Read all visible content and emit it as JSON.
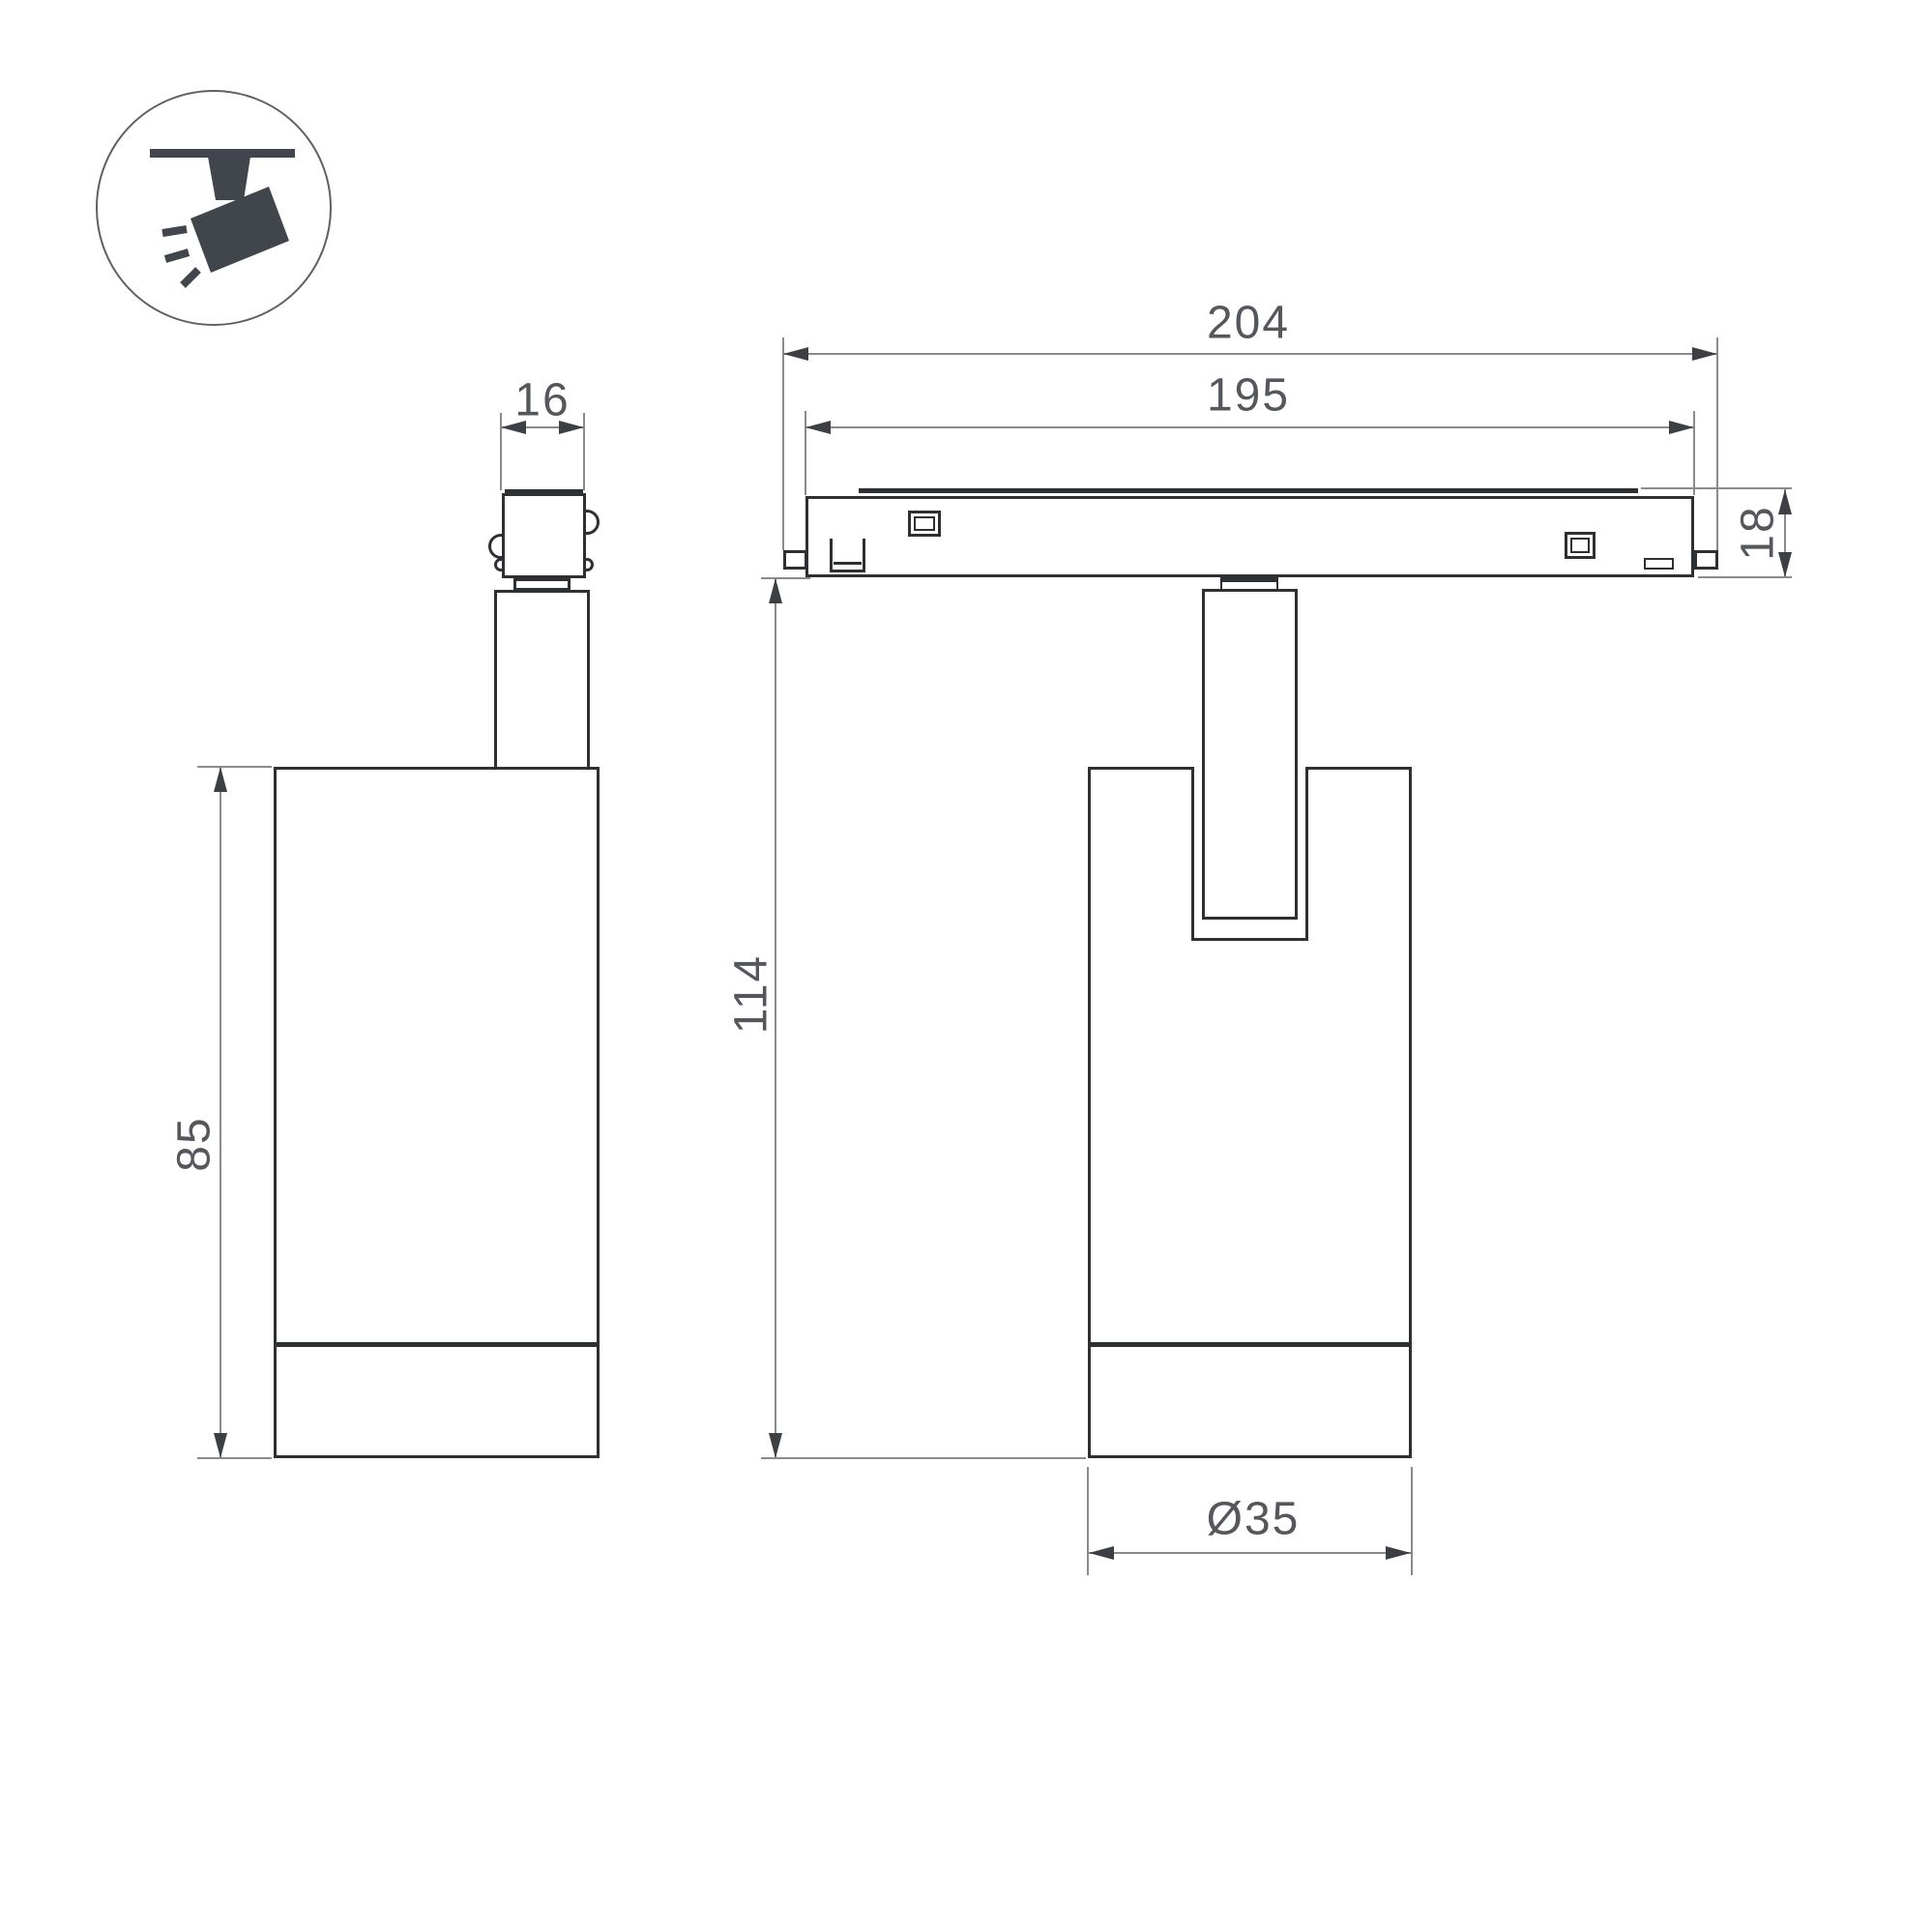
{
  "drawing": {
    "title": "track-spotlight-dimension-drawing",
    "icon": "ceiling-track-spotlight-pictogram",
    "dimensions": {
      "adapter_width": "16",
      "body_height": "85",
      "track_length_outer": "204",
      "track_length_inner": "195",
      "track_height": "18",
      "total_height": "114",
      "body_diameter": "Ø35"
    },
    "colors": {
      "object_line": "#2d3134",
      "dimension_line": "#888c90",
      "arrow": "#3c4044",
      "text": "#54585c",
      "icon_glyph": "#40464b",
      "background": "#ffffff"
    }
  }
}
